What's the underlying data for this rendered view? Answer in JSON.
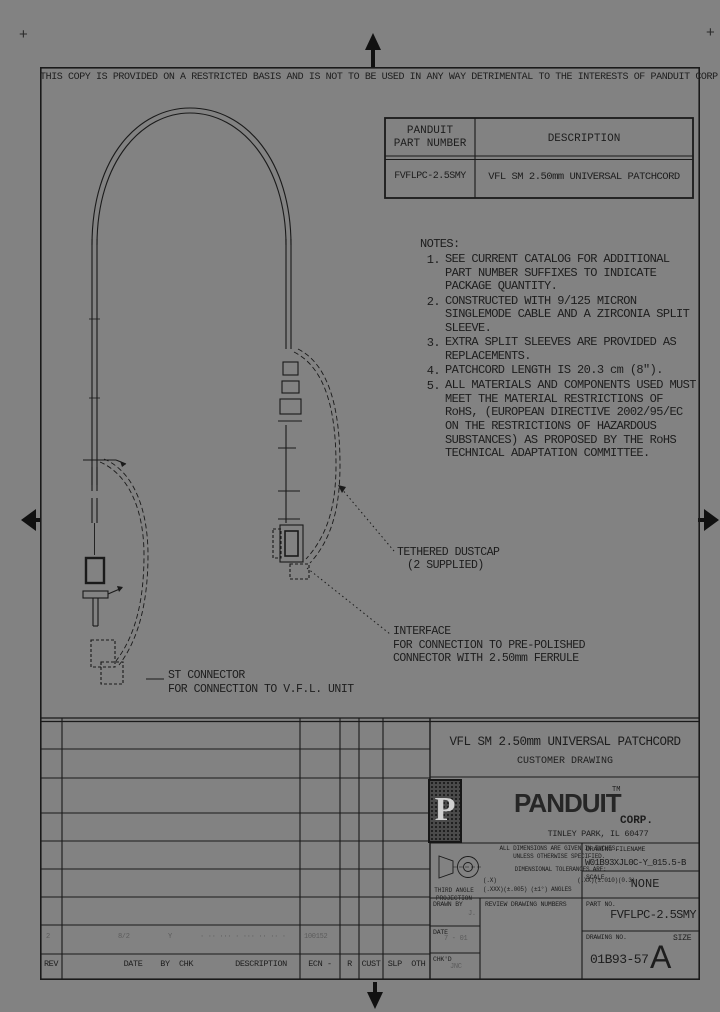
{
  "page": {
    "bg": "#828282",
    "line_color": "#1a1a1a",
    "disclaimer": "THIS COPY IS PROVIDED ON A RESTRICTED BASIS AND IS NOT TO BE USED IN ANY WAY DETRIMENTAL TO THE INTERESTS OF PANDUIT CORP."
  },
  "part_table": {
    "header_col1_line1": "PANDUIT",
    "header_col1_line2": "PART NUMBER",
    "header_col2": "DESCRIPTION",
    "row": {
      "part_number": "FVFLPC-2.5SMY",
      "description": "VFL SM 2.50mm UNIVERSAL PATCHCORD"
    }
  },
  "notes": {
    "heading": "NOTES:",
    "items": [
      {
        "num": "1.",
        "text": "SEE CURRENT CATALOG FOR ADDITIONAL PART NUMBER SUFFIXES TO INDICATE PACKAGE QUANTITY."
      },
      {
        "num": "2.",
        "text": "CONSTRUCTED WITH 9/125 MICRON SINGLEMODE CABLE AND A ZIRCONIA SPLIT SLEEVE."
      },
      {
        "num": "3.",
        "text": "EXTRA SPLIT SLEEVES ARE PROVIDED AS REPLACEMENTS."
      },
      {
        "num": "4.",
        "text": "PATCHCORD LENGTH IS 20.3 cm (8\")."
      },
      {
        "num": "5.",
        "text": "ALL MATERIALS AND COMPONENTS USED MUST MEET THE MATERIAL RESTRICTIONS OF RoHS, (EUROPEAN DIRECTIVE 2002/95/EC ON THE RESTRICTIONS OF HAZARDOUS SUBSTANCES) AS PROPOSED BY THE RoHS TECHNICAL ADAPTATION COMMITTEE."
      }
    ]
  },
  "callouts": {
    "dustcap_line1": "TETHERED DUSTCAP",
    "dustcap_line2": "(2 SUPPLIED)",
    "interface": "INTERFACE\nFOR CONNECTION TO PRE-POLISHED\nCONNECTOR WITH 2.50mm FERRULE",
    "st_connector": "ST CONNECTOR\nFOR CONNECTION TO V.F.L. UNIT"
  },
  "title_block": {
    "title": "VFL SM 2.50mm UNIVERSAL PATCHCORD",
    "subtitle": "CUSTOMER DRAWING",
    "logo_letter": "P",
    "company": "PANDUIT",
    "tm": "TM",
    "corp": "CORP.",
    "address": "TINLEY PARK, IL 60477",
    "dims_note": "ALL DIMENSIONS ARE GIVEN IN INCHES,\nUNLESS OTHERWISE SPECIFIED.",
    "tol_heading": "DIMENSIONAL TOLERANCES ARE:",
    "tol_line1_a": "(.X)",
    "tol_line1_b": "(.XX)(±.010)(0.3)",
    "tol_line2": "(.XXX)(±.005) (±1°) ANGLES",
    "third_angle": "THIRD ANGLE\nPROJECTION",
    "drawing_filename_label": "DRAWING FILENAME",
    "drawing_filename": "W01B93XJL0C-Y_015.5-B",
    "scale_label": "SCALE",
    "scale_value": "NONE",
    "drawn_by_label": "DRAWN BY",
    "drawn_by_value": "J.",
    "review_label": "REVIEW DRAWING NUMBERS",
    "date_label": "DATE",
    "date_value": "7 - 01",
    "chkd_label": "CHK'D",
    "chkd_value": "JNC",
    "part_no_label": "PART NO.",
    "part_no_value": "FVFLPC-2.5SMY",
    "drawing_no_label": "DRAWING NO.",
    "drawing_no_value": "01B93-57",
    "size_label": "SIZE",
    "size_value": "A"
  },
  "revision_strip": {
    "headers": {
      "rev": "REV",
      "date": "DATE",
      "by": "BY",
      "chk": "CHK",
      "description": "DESCRIPTION",
      "ecn": "ECN -",
      "r": "R",
      "cust": "CUST",
      "slp_oth": "SLP  OTH"
    },
    "entry": {
      "rev": "2",
      "date": "8/2",
      "by": "Y",
      "description": "· ·· ··· · ··· ·· ·· ·",
      "ecn": "100152"
    }
  }
}
